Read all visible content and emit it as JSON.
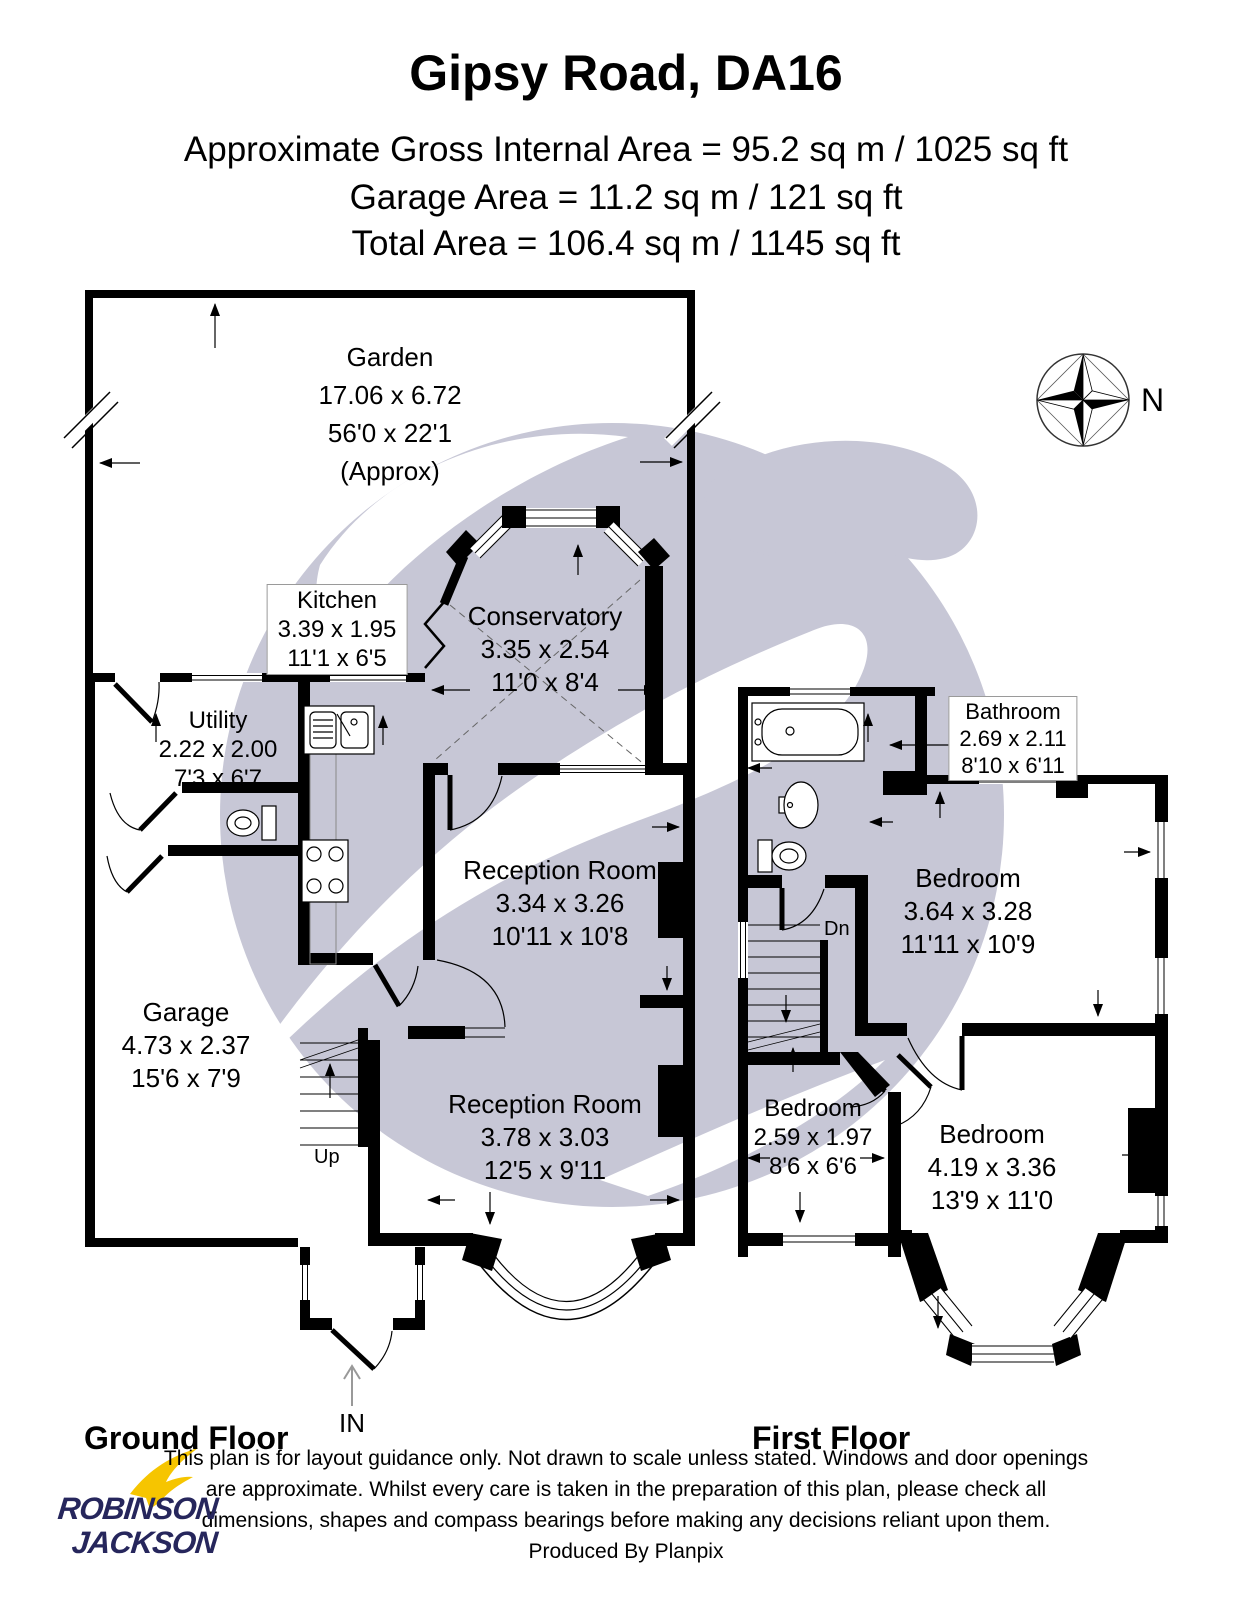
{
  "header": {
    "title": "Gipsy Road, DA16",
    "area_line1": "Approximate Gross Internal Area = 95.2 sq m / 1025 sq ft",
    "area_line2": "Garage Area = 11.2 sq m / 121 sq ft",
    "area_line3": "Total Area = 106.4 sq m / 1145 sq ft"
  },
  "compass": {
    "north_label": "N"
  },
  "ground_floor": {
    "floor_label": "Ground Floor",
    "stairs_label": "Up",
    "entrance_label": "IN",
    "rooms": {
      "garden": {
        "name": "Garden",
        "metric": "17.06 x 6.72",
        "imperial": "56'0 x 22'1",
        "note": "(Approx)"
      },
      "kitchen": {
        "name": "Kitchen",
        "metric": "3.39 x 1.95",
        "imperial": "11'1 x 6'5"
      },
      "conservatory": {
        "name": "Conservatory",
        "metric": "3.35 x 2.54",
        "imperial": "11'0 x 8'4"
      },
      "utility": {
        "name": "Utility",
        "metric": "2.22 x 2.00",
        "imperial": "7'3 x 6'7"
      },
      "garage": {
        "name": "Garage",
        "metric": "4.73 x 2.37",
        "imperial": "15'6 x 7'9"
      },
      "reception1": {
        "name": "Reception Room",
        "metric": "3.34 x 3.26",
        "imperial": "10'11 x 10'8"
      },
      "reception2": {
        "name": "Reception Room",
        "metric": "3.78 x 3.03",
        "imperial": "12'5 x 9'11"
      }
    }
  },
  "first_floor": {
    "floor_label": "First Floor",
    "stairs_label": "Dn",
    "rooms": {
      "bathroom": {
        "name": "Bathroom",
        "metric": "2.69 x 2.11",
        "imperial": "8'10 x 6'11"
      },
      "bedroom1": {
        "name": "Bedroom",
        "metric": "3.64 x 3.28",
        "imperial": "11'11 x 10'9"
      },
      "bedroom2": {
        "name": "Bedroom",
        "metric": "2.59 x 1.97",
        "imperial": "8'6 x 6'6"
      },
      "bedroom3": {
        "name": "Bedroom",
        "metric": "4.19 x 3.36",
        "imperial": "13'9 x 11'0"
      }
    }
  },
  "footer": {
    "disclaimer_lines": [
      "This plan is for layout guidance only. Not drawn to scale unless stated. Windows and door openings",
      "are approximate. Whilst every care is taken in the preparation of this plan, please check all",
      "dimensions, shapes and compass bearings before making any decisions reliant upon them.",
      "Produced By Planpix"
    ]
  },
  "logo": {
    "line1": "ROBINSON",
    "line2": "JACKSON"
  },
  "colors": {
    "watermark": "#c7c7d6",
    "logo_navy": "#26265c",
    "logo_yellow": "#f6c500",
    "ink": "#000000"
  }
}
